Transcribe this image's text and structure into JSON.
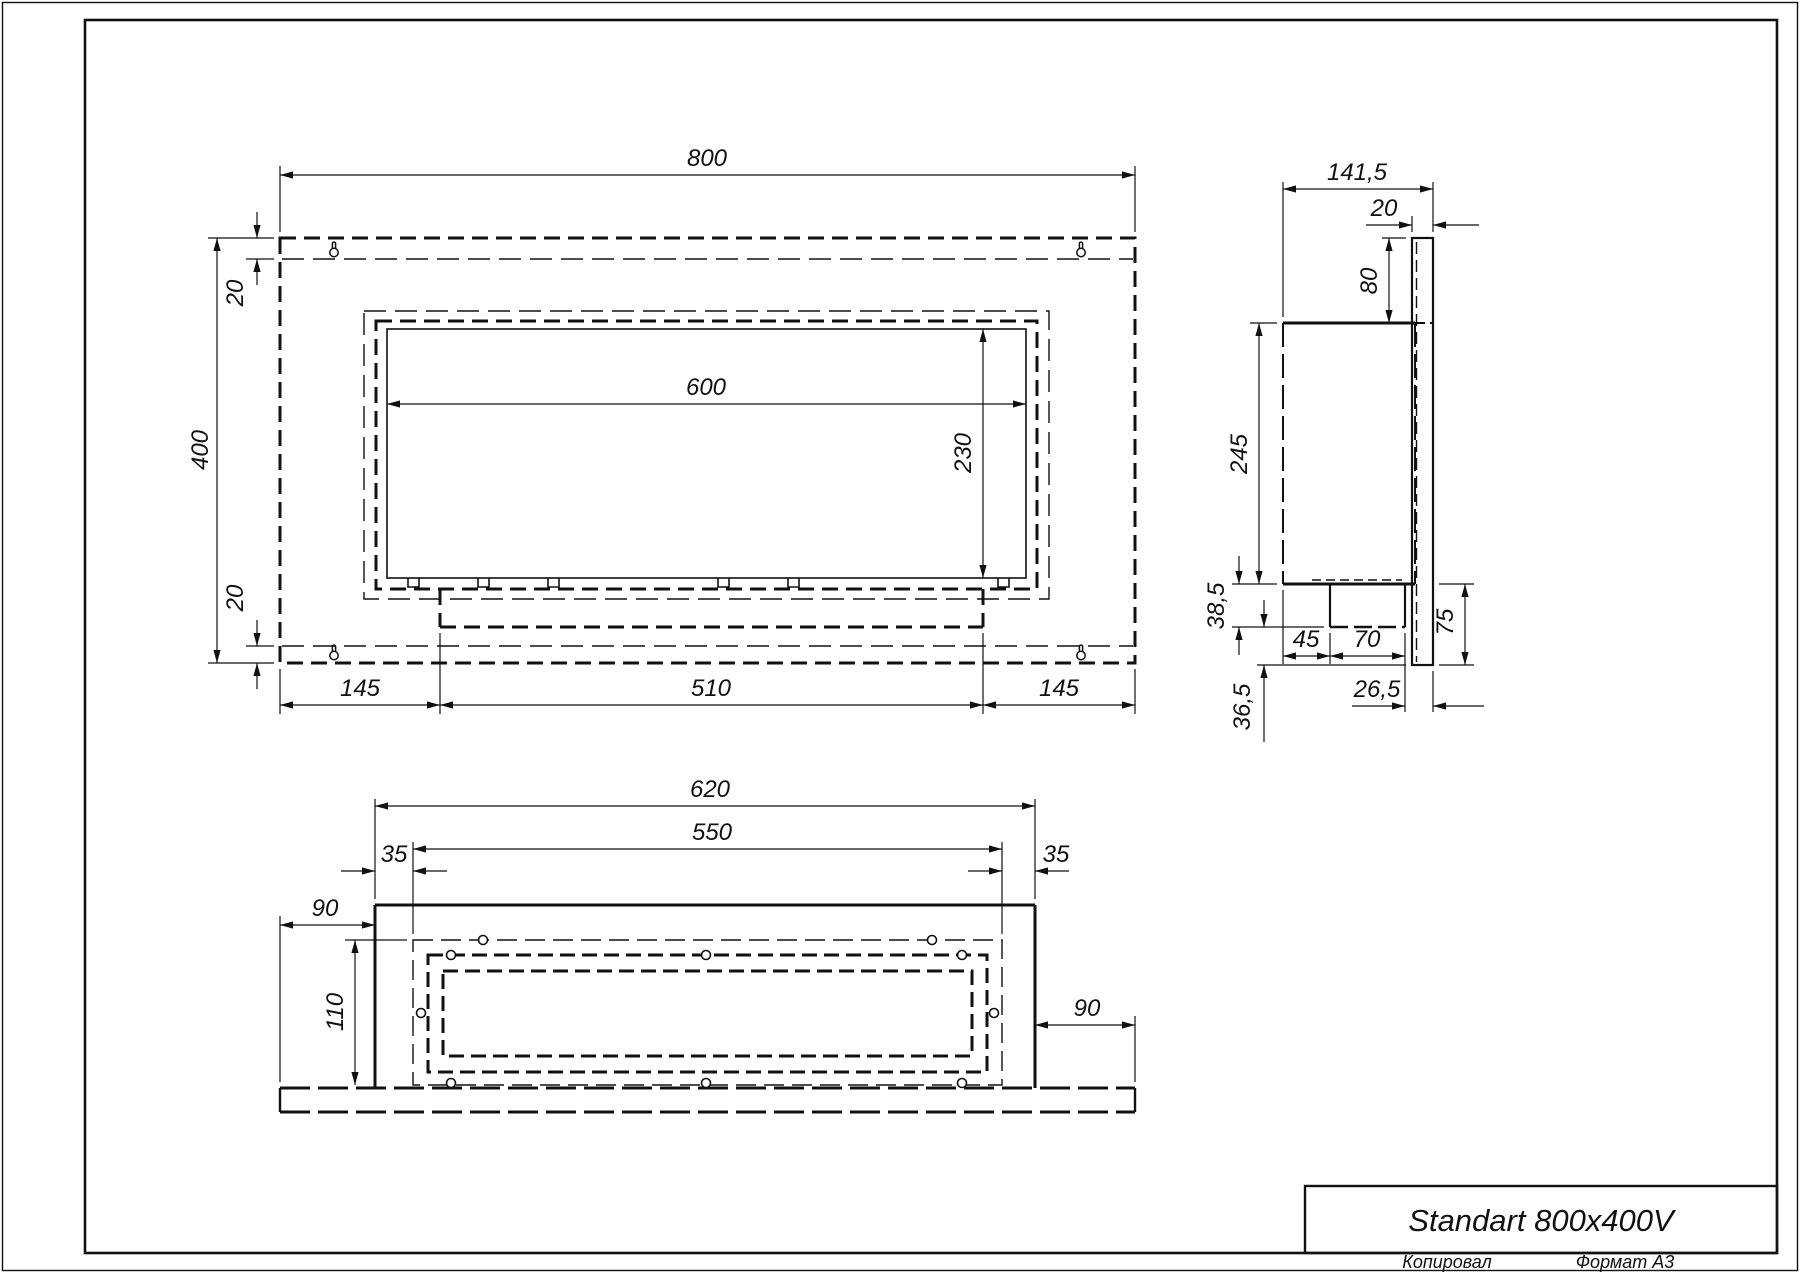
{
  "page": {
    "background": "#ffffff",
    "line_color": "#111111",
    "format_note": "A3 landscape engineering drawing"
  },
  "title_block": {
    "title": "Standart 800x400V",
    "copied": "Копировал",
    "format": "Формат А3"
  },
  "dims": {
    "front": {
      "width": "800",
      "height": "400",
      "top_offset": "20",
      "bottom_offset": "20",
      "glass_width": "600",
      "glass_height": "230",
      "left_margin": "145",
      "tray_width": "510",
      "right_margin": "145"
    },
    "side": {
      "depth": "141,5",
      "plate_thickness": "20",
      "plate_top_rise": "80",
      "body_height": "245",
      "burner_drop": "38,5",
      "bottom_gap": "36,5",
      "front_offset": "45",
      "burner_depth": "70",
      "back_offset": "26,5",
      "plate_bottom_drop": "75"
    },
    "bottom": {
      "body_width": "620",
      "opening_width": "550",
      "inset_left": "35",
      "inset_right": "35",
      "margin_left": "90",
      "margin_right": "90",
      "opening_depth": "110"
    }
  }
}
